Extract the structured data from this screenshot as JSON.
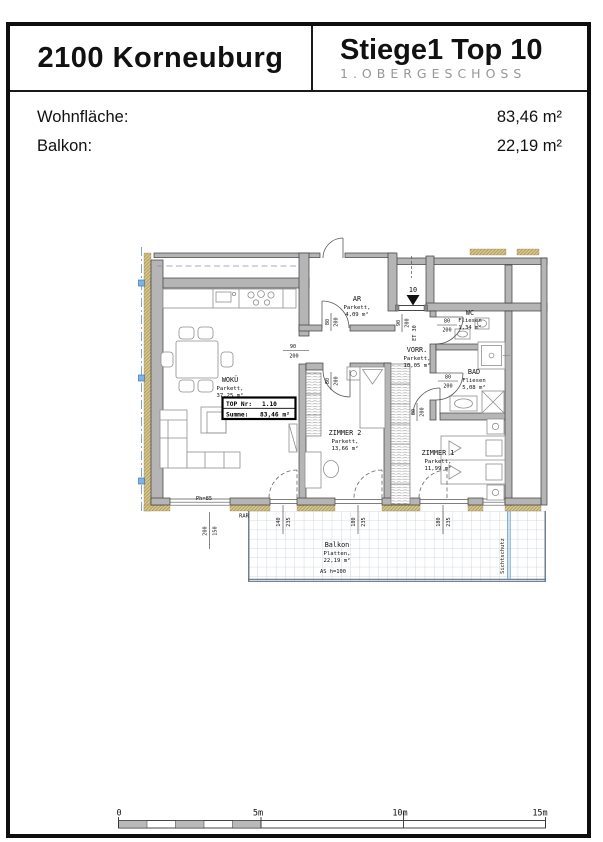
{
  "header": {
    "location": "2100 Korneuburg",
    "unit": "Stiege1 Top 10",
    "floor": "1.OBERGESCHOSS"
  },
  "areas": {
    "wohnflaeche_label": "Wohnfläche:",
    "wohnflaeche_value": "83,46 m²",
    "balkon_label": "Balkon:",
    "balkon_value": "22,19 m²"
  },
  "plan": {
    "entrance_number": "10",
    "rooms": {
      "wokue": {
        "name": "WOKÜ",
        "material": "Parkett,",
        "area": "37,25 m²"
      },
      "ar": {
        "name": "AR",
        "material": "Parkett,",
        "area": "4,09 m²"
      },
      "vorr": {
        "name": "VORR.",
        "material": "Parkett,",
        "area": "10,05 m²"
      },
      "wc": {
        "name": "WC",
        "material": "Fliesen",
        "area": "1,34 m²"
      },
      "bad": {
        "name": "BAD",
        "material": "Fliesen",
        "area": "5,08 m²"
      },
      "zimmer2": {
        "name": "ZIMMER 2",
        "material": "Parkett,",
        "area": "13,66 m²"
      },
      "zimmer1": {
        "name": "ZIMMER 1",
        "material": "Parkett,",
        "area": "11,99 m²"
      },
      "balkon": {
        "name": "Balkon",
        "material": "Platten,",
        "area": "22,19 m²"
      }
    },
    "top_box": {
      "label1": "TOP Nr:",
      "value1": "1.10",
      "label2": "Summe:",
      "value2": "83,46 m²"
    },
    "dims": {
      "opening90": {
        "a": "90",
        "b": "200"
      },
      "door80": {
        "a": "80",
        "b": "200"
      },
      "entrance": {
        "a": "90",
        "b": "200"
      },
      "entrance_type": "ET 30",
      "win200": {
        "a": "200",
        "b": "150"
      },
      "win140": {
        "a": "140",
        "b": "235"
      },
      "win180": {
        "a": "180",
        "b": "235"
      }
    },
    "annotations": {
      "parapet": "Ph=85",
      "rar": "RAR",
      "balcony_note": "AS h=100",
      "privacy": "Sichtschutz"
    }
  },
  "scalebar": {
    "t0": "0",
    "t5": "5m",
    "t10": "10m",
    "t15": "15m"
  }
}
